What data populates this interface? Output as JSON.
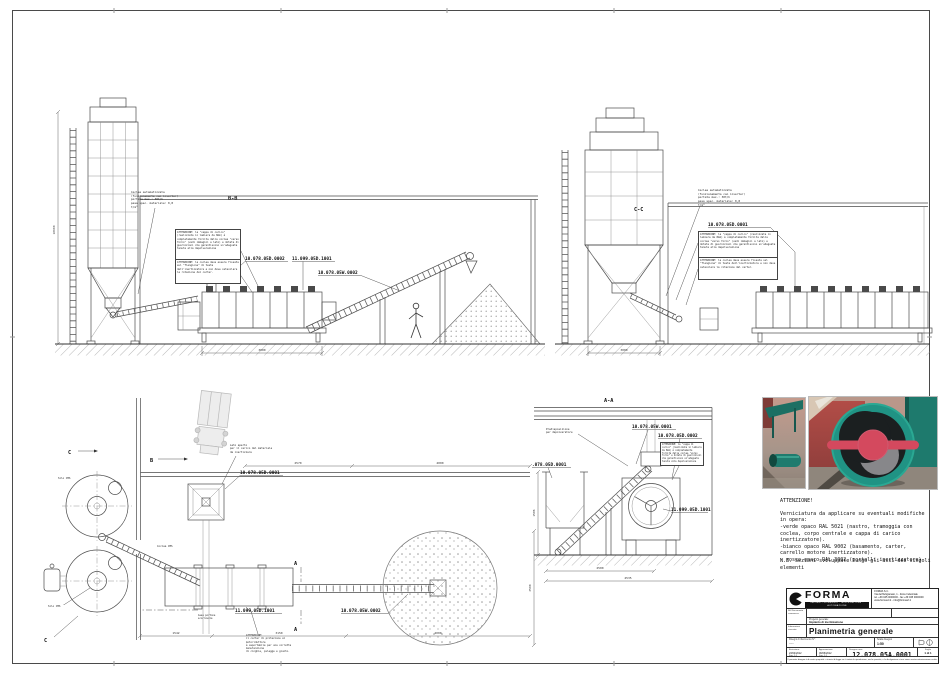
{
  "colors": {
    "line": "#444444",
    "hatch": "#999999",
    "photo_teal": "#1f7a6e",
    "photo_red": "#d4495e",
    "paper": "#ffffff"
  },
  "bb": {
    "title": "B-B",
    "note_coclea": "Coclea automatizzata\n(funzionamento con inverter)\nportata max.: 30t/h\npeso spec. materiale: 0,8 t/m³",
    "attn1": "ATTENZIONE: la \"cappa di carico\" (realizzata in lamiera da 8mm) è completamente fornita dalla coclea \"verso forno\" (vedi immagini a lato) e dotata di guarnizioni che garantiscono un'adeguata tenuta alla depolverazione",
    "attn2": "ATTENZIONE: la coclea deve essere fissata sul \"flangione\" di testa dell'inertizzatore e non deve ostacolare la rotazione del carter.",
    "p1": "10.078.05D.0002",
    "p2": "11.099.05D.1001",
    "p3": "10.078.05W.0002",
    "dim1": "3000",
    "dim_left": "10600"
  },
  "cc": {
    "title": "C-C",
    "note_coclea": "Coclea automatizzata\n(funzionamento con inverter)\nportata max.: 30t/h\npeso spec. materiale: 0,8 t/m³",
    "attn1": "ATTENZIONE: la \"cappa di carico\" (realizzata in lamiera da 8mm) è completamente fornita dalla coclea \"verso forno\" (vedi immagini a lato) e dotata di guarnizioni che garantiscono un'adeguata tenuta alla depolverazione",
    "attn2": "ATTENZIONE: la coclea deve essere fissata sul \"flangione\" di testa dell'inertizzatore e non deve ostacolare la rotazione del carter.",
    "p1": "10.078.05D.0001",
    "dim1": "3000"
  },
  "plan": {
    "p_hopper": "10.078.05D.0001",
    "p_train": "11.099.05D.1001",
    "p_conveyor": "10.078.05W.0002",
    "note_lato": "Lato aperto\nper il carico del materiale\nda inertizzare",
    "note_portone": "Asse portone\nscorrevole",
    "attn_carter": "ATTENZIONE:\nil carter di protezione al motoriduttore\nè asportabile per una corretta manutenzione\ndi cinghie, pulegge e giunto.",
    "silo1": "Silo CMS",
    "silo2": "Silo CMS",
    "coclea": "Coclea CMS",
    "sec_c": "C",
    "sec_b": "B",
    "sec_a": "A",
    "dim1": "2570",
    "dim2": "4000",
    "dim3": "1542",
    "dim4": "3150",
    "dim5": "4000",
    "dim6": "2500"
  },
  "aa": {
    "title": "A-A",
    "p1": "10.078.05W.0001",
    "p2": "10.078.05D.0002",
    "p3": ".078.05D.0001",
    "p4": "11.099.05D.1001",
    "note_depol": "Predisposizione\nper depolveratore",
    "attn1": "ATTENZIONE: la \"cappa di carico\" (realizzata in lamiera da 8mm) è completamente fornita dalla coclea \"verso forno\" e dotata di guarnizioni che garantiscono un'adeguata tenuta alla depolverazione",
    "dim1": "2500",
    "dim2": "4535",
    "dim_left": "1586"
  },
  "attention": {
    "title": "ATTENZIONE!",
    "body": "Verniciatura da applicare su eventuali modifiche\nin opera:\n-verde opaco RAL 5021 (nastro, tramoggia con\ncoclea, corpo centrale e cappa di carico\ninertizzatore).\n-bianco opaco RAL 9002 (basamento, carter,\ncarrello motore inertizzatore).\n- rosso opaco RAL 3002 (portelli inertizzatore)",
    "nb": "N.B. Sezioni sviluppate lungo gli assi dei singoli\nelementi"
  },
  "tb": {
    "brand": "FORMA",
    "tagline": "IMPIANTI DOSAGGIO · MISCELAZIONE · AUTOMAZIONE",
    "company_info": "FORMA S.r.l.\nVia dell'Artigianato, 1 - Zona Industriale\ntel. +39 045 0000000 - fax +39 045 0000000\nwww.formasrl.it - info@formasrl.it",
    "ref_label": "Rif./Documento\ncommessa:",
    "client_label": "Nome e Cliente:",
    "client_value": "-----",
    "location_label": "Località:",
    "location_value": "---",
    "project_label": "Progetto generale:",
    "project_value": "Impianto di inertizzazione",
    "info_label": "Informazioni\nriservate:",
    "title": "Planimetria generale",
    "refs_label": "Disegni di riferimento N°:",
    "refs_value": "-----",
    "scale_label": "Scala disegno",
    "scale_value": "1:50",
    "issue_label": "Emissione:",
    "issue_date": "23/04/2012",
    "issue_rev": "Fog. 1:1",
    "approve_label": "Approvazione:",
    "approve_date": "06/06/2012",
    "approve_rev": "Fog. 1:1",
    "number_label": "Disegno num.:",
    "number": "12.078.05A.0001 2",
    "sheet_label": "Foglio",
    "sheet_value": "1 di 1",
    "disclaimer": "Il presente disegno è di nostra proprietà: a termini di legge ne è vietata la riproduzione, anche parziale, e la divulgazione a terzi senza nostra autorizzazione scritta."
  }
}
